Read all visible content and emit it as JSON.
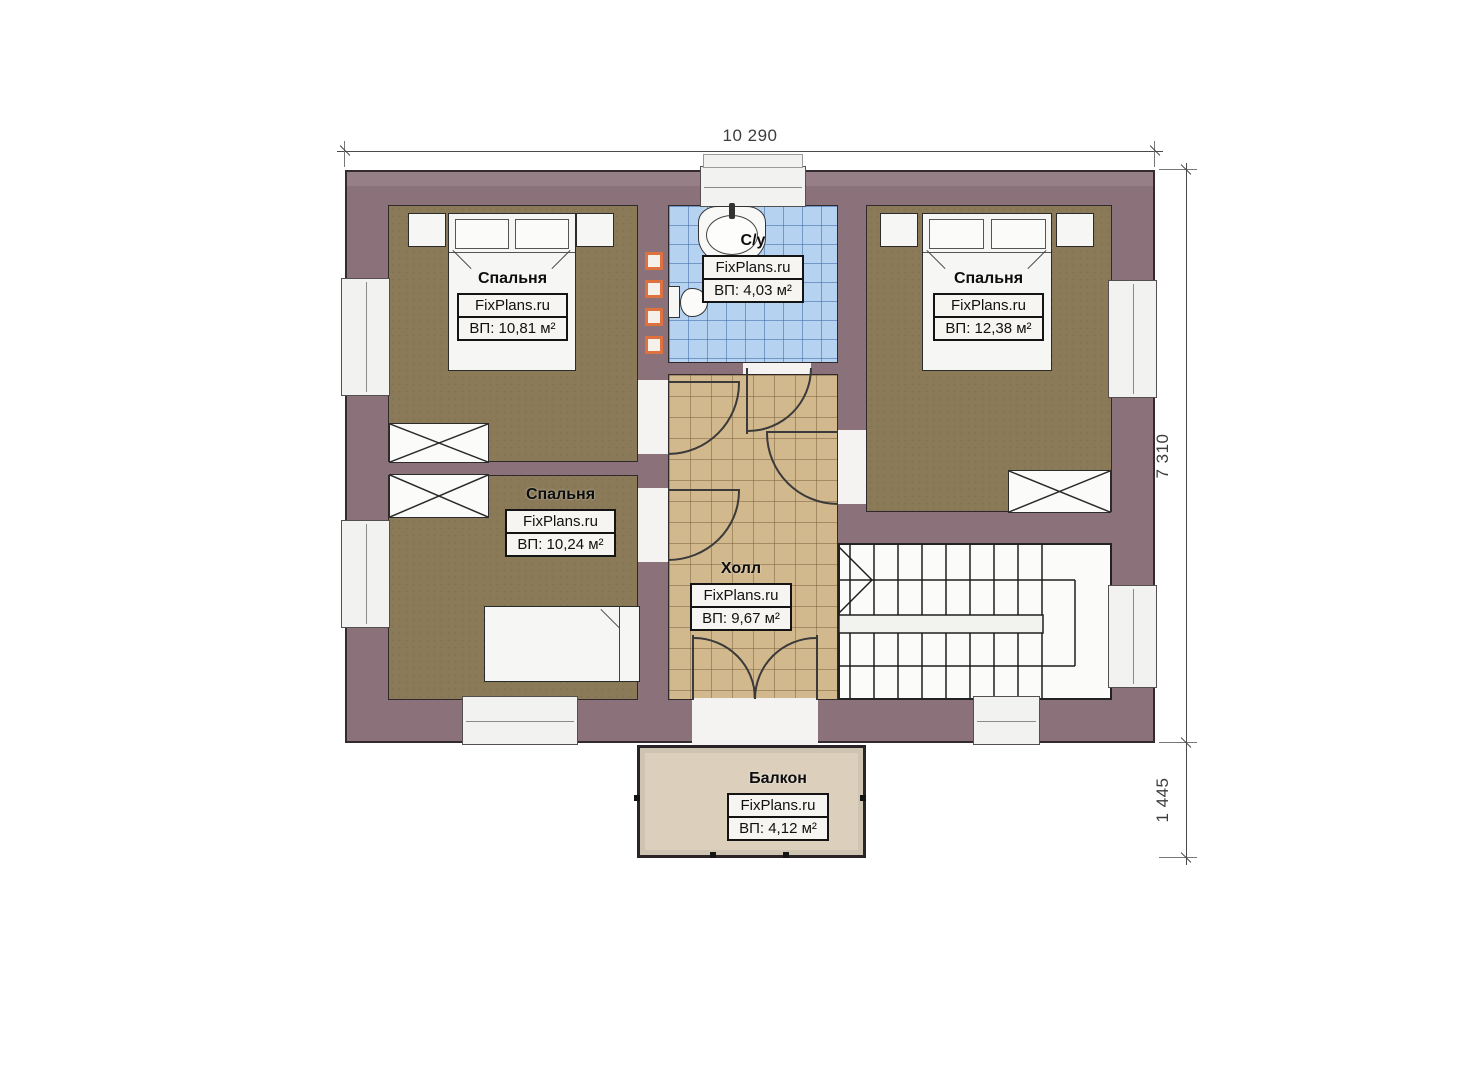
{
  "watermark": "FixPlans.ru",
  "dimensions": {
    "top_width": "10 290",
    "right_height": "7 310",
    "balcony_depth": "1 445"
  },
  "rooms": {
    "bedroom_top_left": {
      "name": "Спальня",
      "area": "ВП: 10,81 м²"
    },
    "bathroom": {
      "name": "С/у",
      "area": "ВП: 4,03 м²"
    },
    "bedroom_top_right": {
      "name": "Спальня",
      "area": "ВП: 12,38 м²"
    },
    "bedroom_mid_left": {
      "name": "Спальня",
      "area": "ВП: 10,24 м²"
    },
    "hall": {
      "name": "Холл",
      "area": "ВП: 9,67 м²"
    },
    "balcony": {
      "name": "Балкон",
      "area": "ВП: 4,12 м²"
    }
  },
  "colors": {
    "wall": "#8b7179",
    "bedroom_floor": "#8b7a58",
    "hall_tile": "#d2b88d",
    "bath_tile": "#b5d2f0",
    "balcony_floor": "#dcd0bd",
    "vent_accent": "#dd7140"
  }
}
